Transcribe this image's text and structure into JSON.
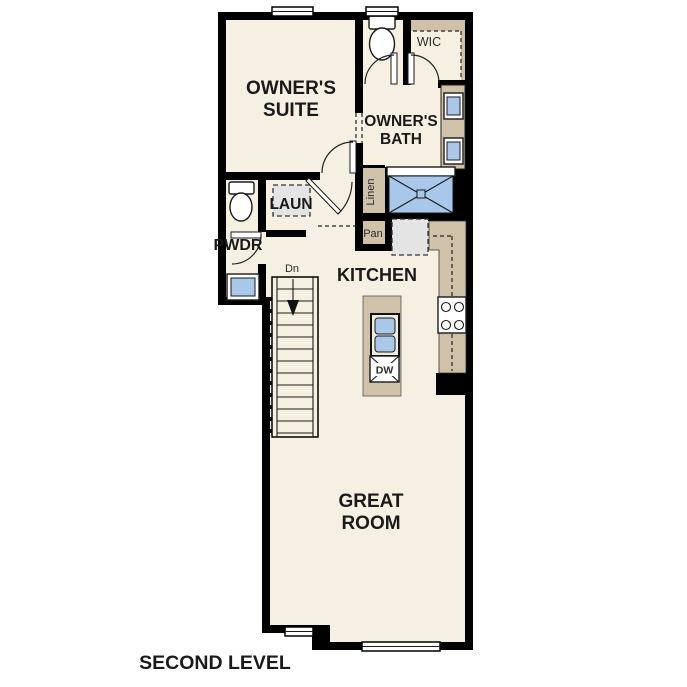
{
  "colors": {
    "bg": "#ffffff",
    "floor": "#f6f0e3",
    "wall": "#000000",
    "cabinet": "#cfc2a9",
    "fixture": "#a9c8e9",
    "appliance": "#e4e4e4",
    "line": "#1a1a1a",
    "text": "#1a1a1a"
  },
  "rooms": {
    "owners_suite": {
      "line1": "OWNER'S",
      "line2": "SUITE"
    },
    "owners_bath": {
      "line1": "OWNER'S",
      "line2": "BATH"
    },
    "wic": {
      "label": "WIC"
    },
    "laundry": {
      "label": "LAUN"
    },
    "powder": {
      "label": "PWDR"
    },
    "kitchen": {
      "label": "KITCHEN"
    },
    "great_room": {
      "line1": "GREAT",
      "line2": "ROOM"
    }
  },
  "fixtures": {
    "linen_label": "Linen",
    "pantry_label": "Pan",
    "dishwasher_label": "DW",
    "stairs_direction_label": "Dn"
  },
  "footer": {
    "level_label": "SECOND LEVEL"
  }
}
